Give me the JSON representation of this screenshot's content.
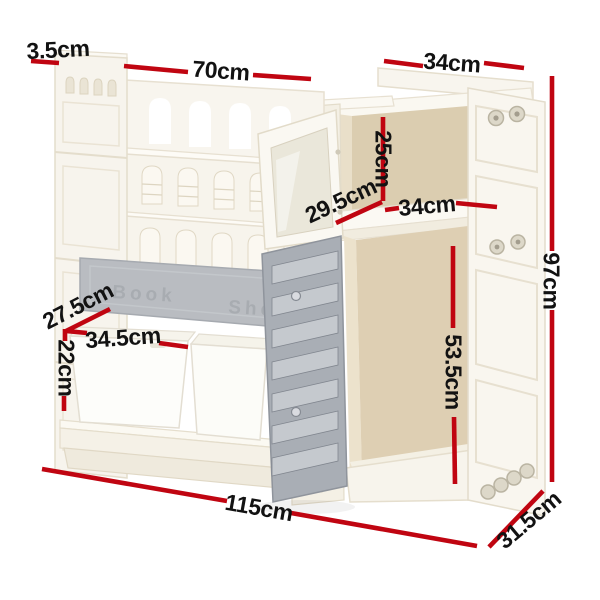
{
  "meta": {
    "description": "Product dimension diagram of a white kids toy storage bookshelf cabinet with red measurement lines"
  },
  "colors": {
    "dimension_line": "#c00511",
    "label_text": "#121212",
    "furniture_cream": "#f7f4ec",
    "furniture_stroke": "#e5decd",
    "interior_tan": "#dbcdb0",
    "door_gray": "#a9aeb5",
    "bar_gray": "#b9bcc1",
    "bin_white": "#fdfdfa",
    "background": "#ffffff"
  },
  "shelf_bar": {
    "left_text": "Book",
    "right_text": "Shelf"
  },
  "dimensions": {
    "side_thickness": {
      "label": "3.5cm"
    },
    "bookshelf_width": {
      "label": "70cm"
    },
    "cabinet_top_width": {
      "label": "34cm"
    },
    "upper_compartment_height": {
      "label": "25cm"
    },
    "upper_compartment_depth": {
      "label": "29.5cm"
    },
    "shelf_width": {
      "label": "34cm"
    },
    "total_height": {
      "label": "97cm"
    },
    "bin_depth": {
      "label": "27.5cm"
    },
    "bin_width": {
      "label": "34.5cm"
    },
    "bin_compartment_height": {
      "label": "22cm"
    },
    "lower_compartment_height": {
      "label": "53.5cm"
    },
    "total_width": {
      "label": "115cm"
    },
    "total_depth": {
      "label": "31.5cm"
    }
  }
}
